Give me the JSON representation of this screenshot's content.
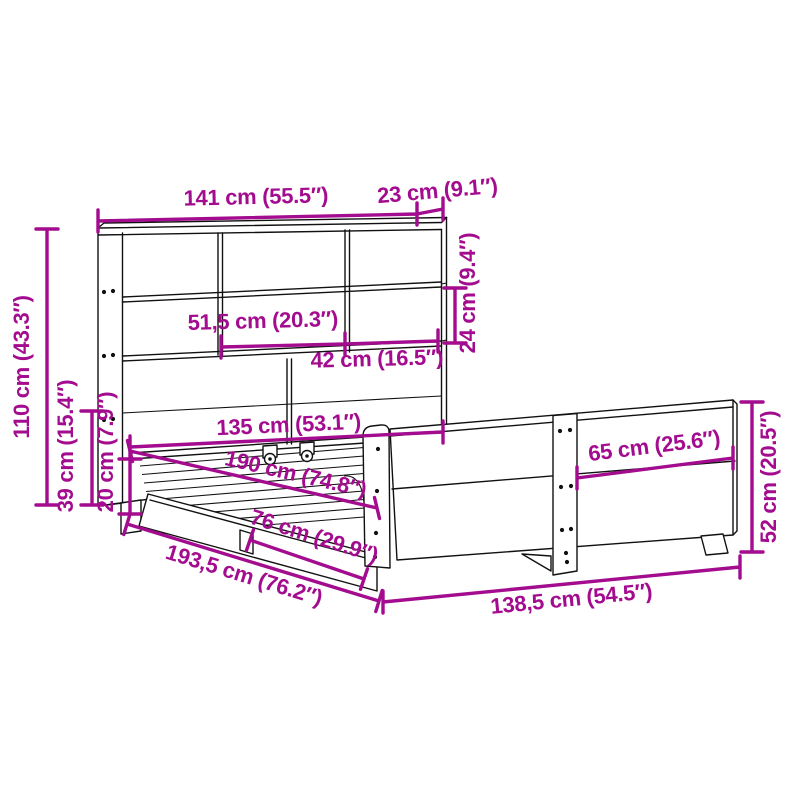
{
  "diagram": {
    "type": "product-dimension-diagram",
    "subject": "bed frame with bookcase headboard and footboard",
    "background": "#ffffff",
    "accent_color": "#A30C8E",
    "line_color": "#111111"
  },
  "dims": [
    {
      "name": "headboard-width",
      "label": "141 cm (55.5″)",
      "cm": "141",
      "inches": "55.5"
    },
    {
      "name": "headboard-depth",
      "label": "23 cm (9.1″)",
      "cm": "23",
      "inches": "9.1"
    },
    {
      "name": "headboard-height",
      "label": "110 cm (43.3″)",
      "cm": "110",
      "inches": "43.3"
    },
    {
      "name": "frame-height",
      "label": "39 cm (15.4″)",
      "cm": "39",
      "inches": "15.4"
    },
    {
      "name": "platform-height",
      "label": "20 cm (7.9″)",
      "cm": "20",
      "inches": "7.9"
    },
    {
      "name": "middle-compartment-width",
      "label": "51,5 cm (20.3″)",
      "cm": "51,5",
      "inches": "20.3"
    },
    {
      "name": "side-compartment-width",
      "label": "42 cm (16.5″)",
      "cm": "42",
      "inches": "16.5"
    },
    {
      "name": "compartment-height",
      "label": "24 cm (9.4″)",
      "cm": "24",
      "inches": "9.4"
    },
    {
      "name": "mattress-width",
      "label": "135 cm (53.1″)",
      "cm": "135",
      "inches": "53.1"
    },
    {
      "name": "mattress-length",
      "label": "190 cm (74.8″)",
      "cm": "190",
      "inches": "74.8"
    },
    {
      "name": "side-board-length",
      "label": "76 cm (29.9″)",
      "cm": "76",
      "inches": "29.9"
    },
    {
      "name": "total-length",
      "label": "193,5 cm (76.2″)",
      "cm": "193,5",
      "inches": "76.2"
    },
    {
      "name": "footboard-section-width",
      "label": "65 cm (25.6″)",
      "cm": "65",
      "inches": "25.6"
    },
    {
      "name": "footboard-height",
      "label": "52 cm (20.5″)",
      "cm": "52",
      "inches": "20.5"
    },
    {
      "name": "total-width",
      "label": "138,5 cm (54.5″)",
      "cm": "138,5",
      "inches": "54.5"
    }
  ]
}
